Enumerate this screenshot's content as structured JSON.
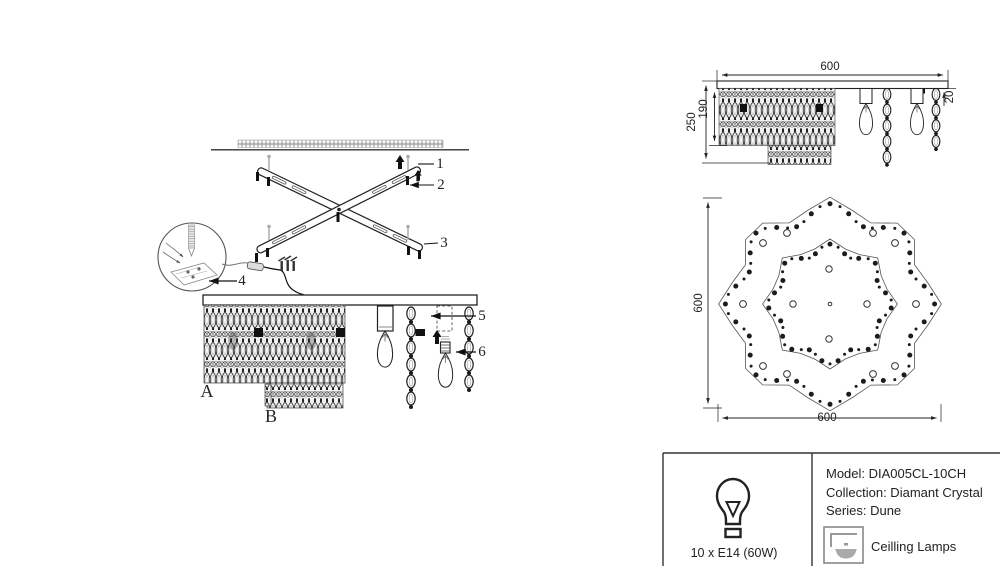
{
  "figure": {
    "kind": "ceiling chandelier installation and dimension drawing"
  },
  "callouts": {
    "c1": "1",
    "c2": "2",
    "c3": "3",
    "c4": "4",
    "c5": "5",
    "c6": "6",
    "panel_a": "A",
    "panel_b": "B"
  },
  "side_view": {
    "width": "600",
    "total_height": "250",
    "curtain_height": "190",
    "plate_thickness": "20"
  },
  "plan_view": {
    "height": "600",
    "width": "600"
  },
  "spec_panel": {
    "lamp_spec": "10 x E14 (60W)",
    "model": "Model: DIA005CL-10CH",
    "collection": "Collection: Diamant Crystal",
    "series": "Series: Dune",
    "category": "Ceilling Lamps",
    "icons": {
      "lamp": "light-bulb-icon",
      "category": "ceiling-lamp-icon"
    }
  }
}
